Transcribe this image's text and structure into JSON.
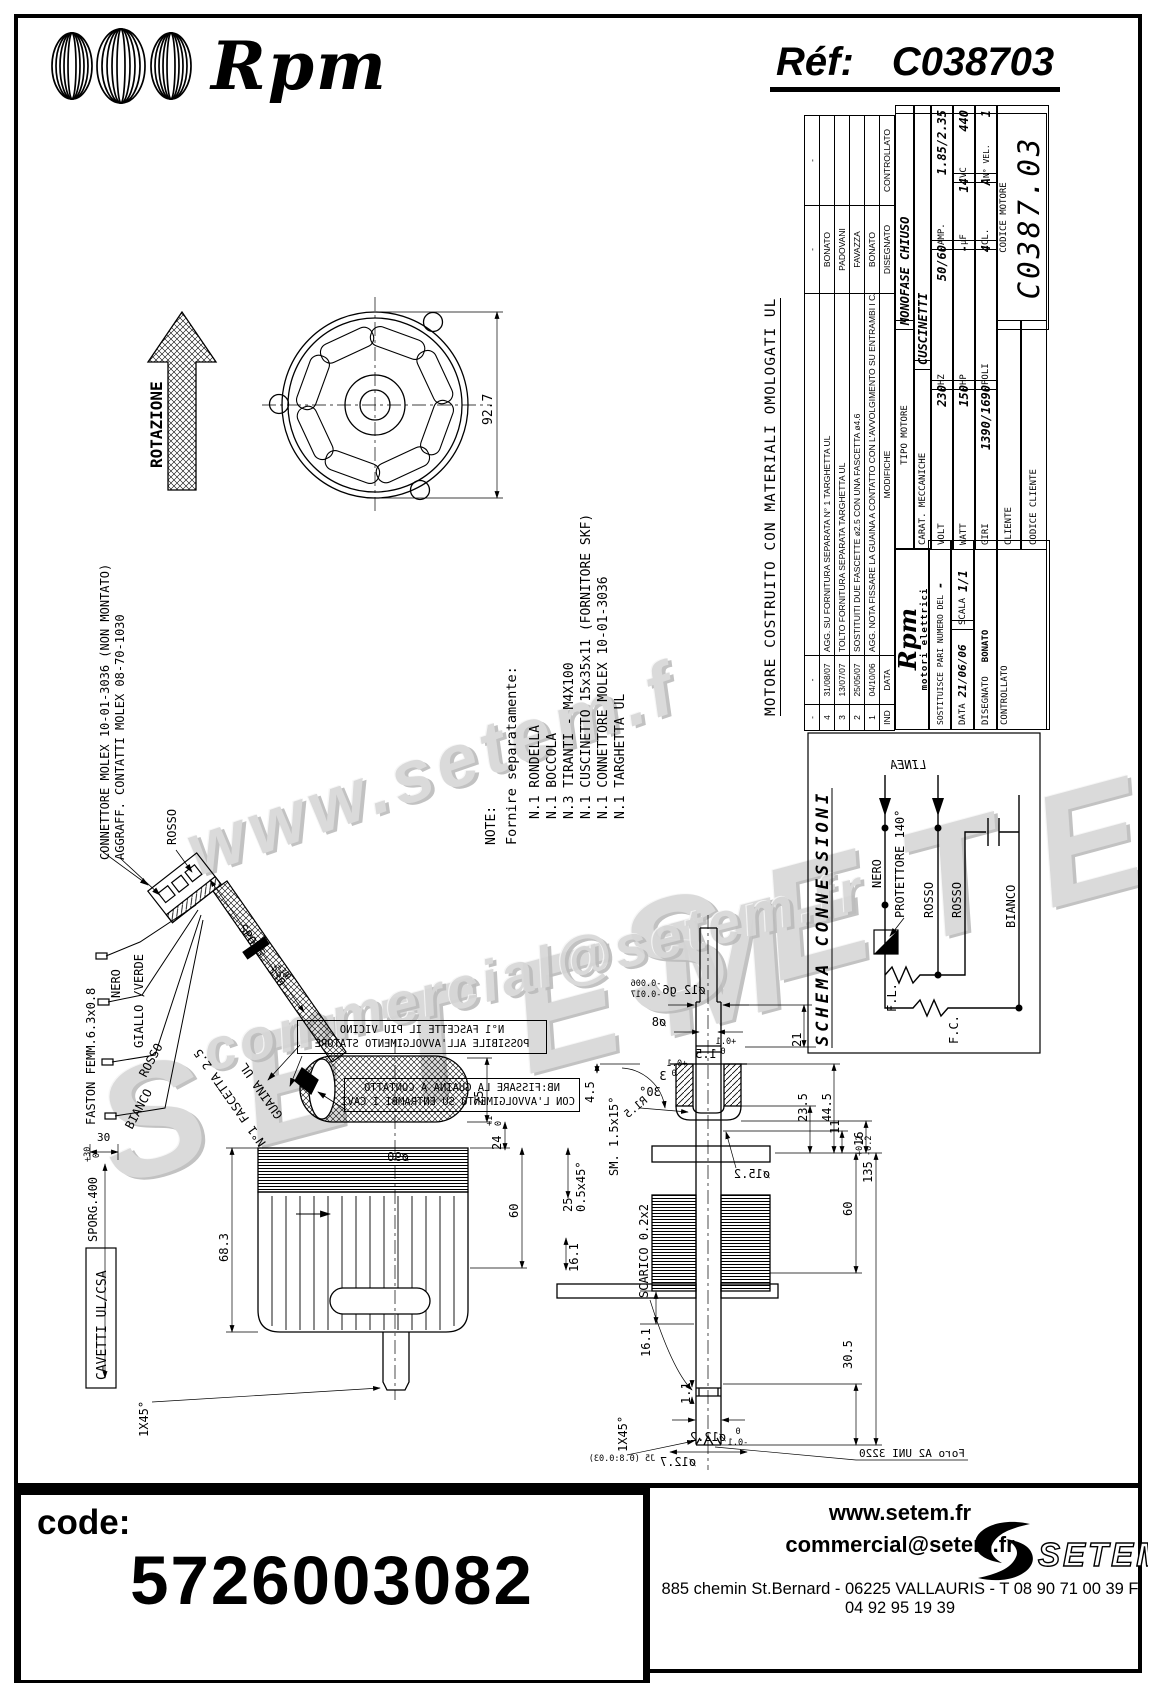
{
  "header": {
    "brand": "Rpm",
    "ref_label": "Réf:",
    "ref_value": "C038703"
  },
  "watermarks": {
    "wm1": "www.setem.f",
    "wm2": "SETEM",
    "wm3": "commercial@setem.fr",
    "wm4": "SETEM"
  },
  "title_block": {
    "title": "MOTORE COSTRUITO CON MATERIALI OMOLOGATI UL",
    "rev": {
      "h_ind": "IND",
      "h_date": "DATA",
      "h_mod": "MODIFICHE",
      "h_dis": "DISEGNATO",
      "h_con": "CONTROLLATO",
      "rows": [
        {
          "ind": "-",
          "date": "-",
          "mod": "",
          "dis": "-",
          "con": "-"
        },
        {
          "ind": "4",
          "date": "31/08/07",
          "mod": "AGG. SU FORNITURA SEPARATA N° 1 TARGHETTA UL",
          "dis": "BONATO",
          "con": ""
        },
        {
          "ind": "3",
          "date": "13/07/07",
          "mod": "TOLTO FORNITURA SEPARATA TARGHETTA UL",
          "dis": "PADOVANI",
          "con": ""
        },
        {
          "ind": "2",
          "date": "25/05/07",
          "mod": "SOSTITUITI DUE FASCETTE ø2.5 CON UNA FASCETTA ø4.6",
          "dis": "FAVAZZA",
          "con": ""
        },
        {
          "ind": "1",
          "date": "04/10/06",
          "mod": "AGG. NOTA FISSARE LA GUAINA A CONTATTO CON L'AVVOLGIMENTO SU ENTRAMBI I CAVI",
          "dis": "BONATO",
          "con": ""
        }
      ]
    },
    "tipo_label": "TIPO MOTORE",
    "tipo": "MONOFASE CHIUSO",
    "carat_label": "CARAT. MECCANICHE",
    "carat": "CUSCINETTI",
    "volt_label": "VOLT",
    "volt": "230",
    "hz_label": "HZ",
    "hz": "50/60",
    "amp_label": "AMP.",
    "amp": "1.85/2.35",
    "watt_label": "WATT",
    "watt": "150",
    "hp_label": "HP",
    "hp": "-",
    "uf_label": "µF",
    "uf": "14",
    "vc_label": "VC",
    "vc": "440",
    "giri_label": "GIRI",
    "giri": "1390/1690",
    "poli_label": "POLI",
    "poli": "4",
    "cl_label": "CL.",
    "cl": "A",
    "nvel_label": "N° VEL.",
    "nvel": "1",
    "codmot_label": "CODICE MOTORE",
    "codmot": "C0387.03",
    "cliente_label": "CLIENTE",
    "codcli_label": "CODICE CLIENTE",
    "logo_brand": "Rpm",
    "logo_sub": "motori elettrici",
    "sost_label": "SOSTITUISCE PARI NUMERO DEL",
    "sost": "-",
    "data_label": "DATA",
    "data": "21/06/06",
    "scala_label": "SCALA",
    "scala": "1/1",
    "dis_label": "DISEGNATO",
    "dis": "BONATO",
    "con_label": "CONTROLLATO"
  },
  "schema": {
    "title": "SCHEMA CONNESSIONI",
    "linea": "LINEA",
    "nero": "NERO",
    "protettore": "PROTETTORE  140°",
    "rosso1": "ROSSO",
    "rosso2": "ROSSO",
    "bianco": "BIANCO",
    "fl": "F.L.",
    "fc": "F.C."
  },
  "notes": {
    "label": "NOTE:",
    "intro": "Fornire separatamente:",
    "items": [
      "N.1 RONDELLA",
      "N.1 BOCCOLA",
      "N.3 TIRANTI - M4X100",
      "N.1 CUSCINETTO 15x35x11  (FORNITORE SKF)",
      "N.1 CONNETTORE MOLEX 10-01-3036",
      "N.1 TARGHETTA UL"
    ]
  },
  "cable": {
    "connettore": "CONNETTORE MOLEX 10-01-3036 (NON MONTATO)",
    "aggraff": "AGGRAFF. CONTATTI MOLEX 08-70-1030",
    "rosso_top": "ROSSO",
    "faston": "FASTON FEMM.6.3x0.8",
    "nero": "NERO",
    "giallo": "GIALLO /VERDE",
    "rosso": "ROSSO",
    "bianco": "BIANCO",
    "fascetta": "N°1 FASCETTA 2.5",
    "guaina": "GUAINA UL",
    "sporg330": "SPORG. 330",
    "sporg330_tol_p": "+30",
    "sporg330_tol_m": "0",
    "d30": "30",
    "sporg400": "SPORG.400",
    "sporg400_tol_p": "+30",
    "sporg400_tol_m": "0",
    "cavetti": "CAVETTI UL/CSA"
  },
  "boxes": {
    "b1l1": "N°1 FASCETTE IL PIU VICINO",
    "b1l2": "POSSIBILE ALL'AVVOLGIMENTO STATORE",
    "b2l1": "NB:FISSARE LA GUAINA A CONTATTO",
    "b2l2": "CON L'AVVOLGIMENTO SU ENTRAMBI I CAVI"
  },
  "dims": {
    "rotazione": "ROTAZIONE",
    "d927": "92.7",
    "d25a": "25",
    "d24": "24",
    "t24p": "+1",
    "t24m": "0",
    "d60a": "60",
    "dia90": "ø90",
    "d683": "68.3",
    "d161a": "16.1",
    "d161b": "16.1",
    "d11a": "1.1",
    "ch45a": "1X45°",
    "ch45b": "1X45°",
    "d45": "4.5",
    "ch05": "0.5x45°",
    "scarico": "SCARICO 0.2x2",
    "d25b": "25",
    "dia12": "ø12 g6",
    "t12a": "-0.006",
    "t12b": "-0.017",
    "dia8": "ø8",
    "d15": "1.5",
    "t01p": "+0.1",
    "t01m": "0",
    "d3": "3",
    "t3p": "+0.1",
    "t3m": "0",
    "a30": "30°",
    "r15": "R1.5",
    "sm": "SM. 1.5x15°",
    "dia152": "ø15.2",
    "d11r": "11",
    "d16": "16",
    "d21": "21",
    "d235": "23.5",
    "d445": "44.5",
    "d135": "135",
    "t135p": "+0.2",
    "t135m": "-0.2",
    "d60b": "60",
    "d305": "30.5",
    "dia122": "ø12.2",
    "t122p": "0",
    "t122m": "-0.1",
    "dia127": "ø12.7",
    "j5": "J5 (0.8:0.03)",
    "foro": "Foro A2 UNI 3220"
  },
  "footer": {
    "code_label": "code:",
    "code": "5726003082",
    "site": "www.setem.fr",
    "email": "commercial@setem.fr",
    "address": "885 chemin St.Bernard  -  06225 VALLAURIS  -  T 08 90 71 00 39   F 04 92 95 19 39",
    "brand": "SETEM"
  }
}
